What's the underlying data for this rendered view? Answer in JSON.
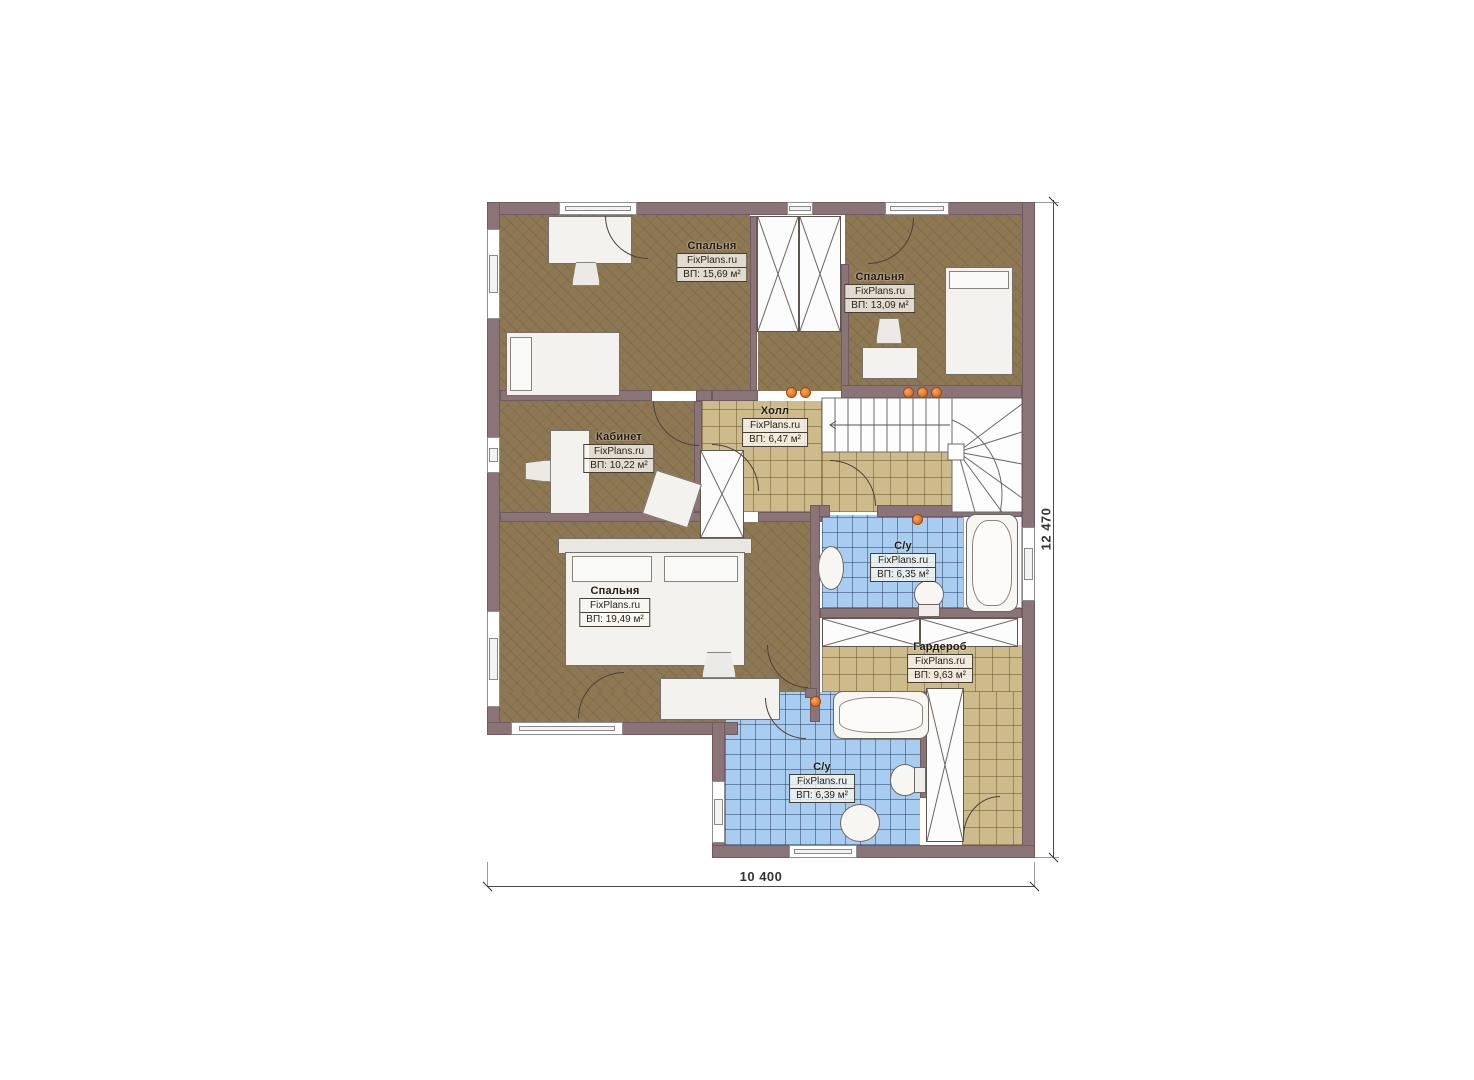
{
  "plan": {
    "title": "floor-plan-second-level",
    "brand": "FixPlans.ru",
    "rooms": [
      {
        "key": "bedroom-1",
        "name": "Спальня",
        "brand": "FixPlans.ru",
        "area": "ВП: 15,69 м²"
      },
      {
        "key": "bedroom-2",
        "name": "Спальня",
        "brand": "FixPlans.ru",
        "area": "ВП: 13,09 м²"
      },
      {
        "key": "hall",
        "name": "Холл",
        "brand": "FixPlans.ru",
        "area": "ВП: 6,47 м²"
      },
      {
        "key": "office",
        "name": "Кабинет",
        "brand": "FixPlans.ru",
        "area": "ВП: 10,22 м²"
      },
      {
        "key": "bedroom-3",
        "name": "Спальня",
        "brand": "FixPlans.ru",
        "area": "ВП: 19,49 м²"
      },
      {
        "key": "bathroom-1",
        "name": "С/у",
        "brand": "FixPlans.ru",
        "area": "ВП: 6,35 м²"
      },
      {
        "key": "wardrobe",
        "name": "Гардероб",
        "brand": "FixPlans.ru",
        "area": "ВП: 9,63 м²"
      },
      {
        "key": "bathroom-2",
        "name": "С/у",
        "brand": "FixPlans.ru",
        "area": "ВП: 6,39 м²"
      }
    ],
    "dimensions": {
      "horizontal": "10 400",
      "vertical": "12 470"
    },
    "colors": {
      "wall": "#8a7478",
      "parquet": "#8d7853",
      "tile_tan": "#cdbb8c",
      "tile_blue": "#a9cdf0",
      "light_dot": "#e8762a"
    }
  }
}
